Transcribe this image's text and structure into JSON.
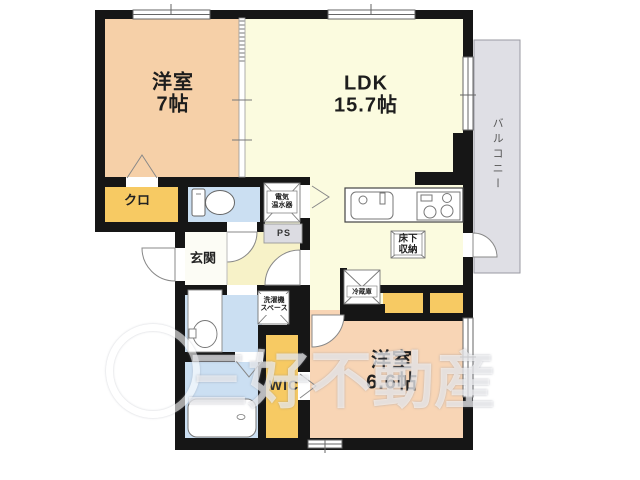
{
  "plan": {
    "rooms": {
      "bedroom_top": {
        "name": "洋室",
        "size": "7帖"
      },
      "ldk": {
        "name": "LDK",
        "size": "15.7帖"
      },
      "bedroom_bottom": {
        "name": "洋室",
        "size": "6.6帖"
      },
      "closet_top": {
        "label": "クロ"
      },
      "entrance": {
        "label": "玄関"
      },
      "wic": {
        "label": "WIC"
      },
      "balcony": {
        "label": "バルコニー"
      },
      "pipe_space": {
        "label": "PS"
      }
    },
    "fixtures": {
      "water_heater": {
        "line1": "電気",
        "line2": "温水器"
      },
      "washer_space": {
        "line1": "洗濯機",
        "line2": "スペース"
      },
      "underfloor_storage": {
        "line1": "床下",
        "line2": "収納"
      },
      "refrigerator": {
        "label": "冷蔵庫"
      }
    },
    "watermark": {
      "text": "三好不動産"
    },
    "colors": {
      "room_peach": "#f6d0a8",
      "room_peach_light": "#f8d5b5",
      "ldk_cream": "#fbfbdf",
      "hall_cream": "#f7f2c8",
      "closet_yellow": "#f7ca63",
      "wet_blue": "#cbdff2",
      "entrance_white": "#fcfcf5",
      "balcony_gray": "#dfdfe5",
      "pipe_space_gray": "#dcdce2",
      "wall_black": "#161616"
    }
  }
}
